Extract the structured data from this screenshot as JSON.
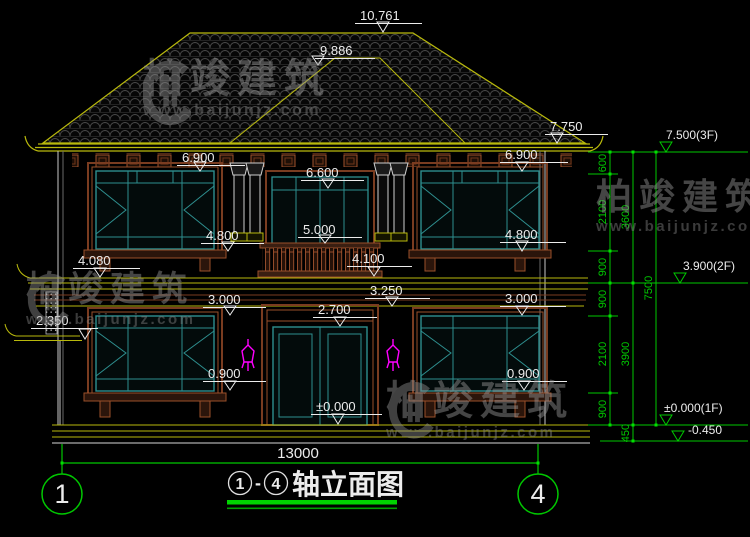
{
  "title": {
    "axis_from": "1",
    "dash": "-",
    "axis_to": "4",
    "name": "轴立面图"
  },
  "grid": {
    "left": "1",
    "right": "4"
  },
  "overall_width": "13000",
  "levels": {
    "peak": "10.761",
    "upper_ridge": "9.886",
    "eave": "7.750",
    "win2_top_left": "6.900",
    "win2_top_right": "6.900",
    "balcony_door_top": "6.600",
    "railing_top": "5.000",
    "win2_sill_left": "4.800",
    "win2_sill_right": "4.800",
    "balcony_floor": "4.100",
    "belt_left": "4.080",
    "canopy_bottom": "3.250",
    "win1_top_left": "3.000",
    "win1_top_right": "3.000",
    "door_top": "2.700",
    "side_awning": "2.350",
    "win1_sill_left": "0.900",
    "win1_sill_right": "0.900",
    "entry_zero": "±0.000"
  },
  "floor_marks": {
    "f3": "7.500(3F)",
    "f2": "3.900(2F)",
    "f1": "±0.000(1F)",
    "below_grade": "-0.450"
  },
  "chains": {
    "inner": [
      "600",
      "2100",
      "900",
      "900",
      "2100",
      "900"
    ],
    "mid": [
      "3600",
      "3900",
      "450"
    ],
    "outer": [
      "7500"
    ]
  },
  "watermark": {
    "brand": "柏竣建筑",
    "url": "www.baijunjz.com"
  },
  "colors": {
    "line_yellow": "#b9b90c",
    "line_green": "#00c800",
    "frame_teal": "#2e8f8f",
    "wood_brown": "#a0522d",
    "lamp_magenta": "#ff00ff"
  }
}
